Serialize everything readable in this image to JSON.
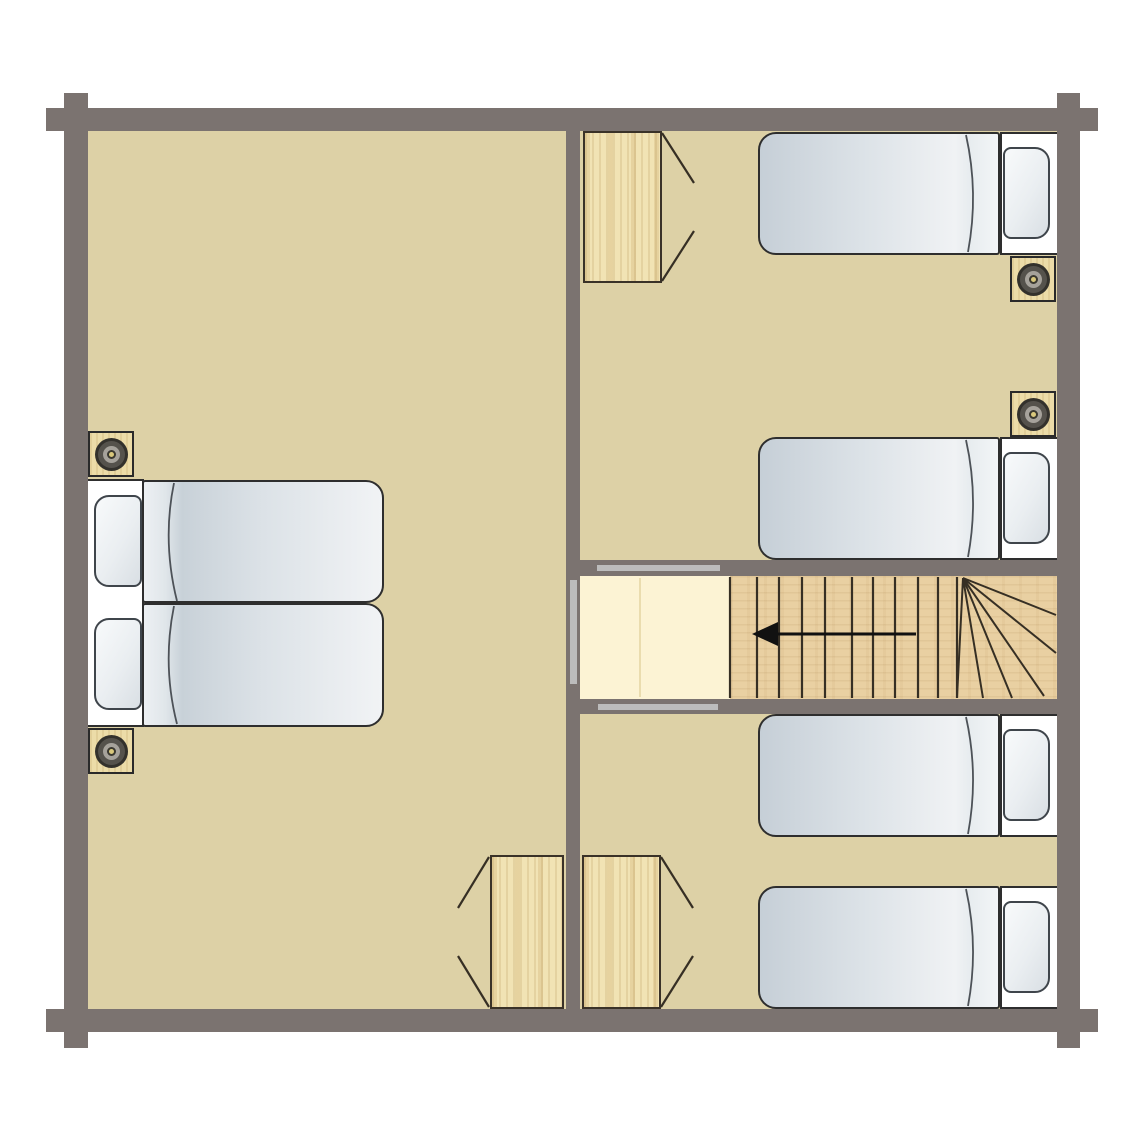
{
  "meta": {
    "type": "floor-plan",
    "subject": "log-cabin upper floor with three bedrooms and staircase",
    "canvas": {
      "width": 1145,
      "height": 1145
    }
  },
  "palette": {
    "wall": "#7b7370",
    "floor": "#ddd1a6",
    "landing": "#fcf3d4",
    "stair_wood": "#e9d0a2",
    "wardrobe_wood": "#f1e3b4",
    "fixture_wood": "#ecdca8",
    "door_marker": "#bcbcbc",
    "outline": "#2e2e2e",
    "swing_line": "#362f24",
    "arrow": "#111111",
    "mattress_dark": "#c6cfd7",
    "mattress_light": "#f3f5f7",
    "spot_center": "#d9c87c"
  },
  "floor": {
    "rect": [
      88,
      131,
      969,
      878
    ]
  },
  "rooms": [
    {
      "name": "master-bedroom",
      "bounds": [
        88,
        131,
        478,
        878
      ]
    },
    {
      "name": "twin-bedroom-north",
      "bounds": [
        580,
        131,
        477,
        429
      ]
    },
    {
      "name": "twin-bedroom-south",
      "bounds": [
        580,
        714,
        477,
        295
      ]
    },
    {
      "name": "stair-corridor",
      "bounds": [
        580,
        576,
        477,
        123
      ]
    }
  ],
  "walls": [
    {
      "name": "wall-top",
      "rect": [
        64,
        108,
        1016,
        23
      ]
    },
    {
      "name": "wall-bottom",
      "rect": [
        64,
        1009,
        1016,
        23
      ]
    },
    {
      "name": "wall-left",
      "rect": [
        64,
        108,
        24,
        924
      ]
    },
    {
      "name": "wall-right",
      "rect": [
        1057,
        108,
        23,
        924
      ]
    },
    {
      "name": "wall-interior-vertical",
      "rect": [
        566,
        131,
        14,
        878
      ]
    },
    {
      "name": "wall-corridor-top",
      "rect": [
        580,
        560,
        477,
        16
      ]
    },
    {
      "name": "wall-corridor-bottom",
      "rect": [
        580,
        699,
        477,
        15
      ]
    }
  ],
  "corner_logs": [
    {
      "name": "log-top-left-h",
      "rect": [
        46,
        108,
        18,
        23
      ]
    },
    {
      "name": "log-top-left-v",
      "rect": [
        64,
        93,
        24,
        15
      ]
    },
    {
      "name": "log-top-right-h",
      "rect": [
        1080,
        108,
        18,
        23
      ]
    },
    {
      "name": "log-top-right-v",
      "rect": [
        1057,
        93,
        23,
        15
      ]
    },
    {
      "name": "log-bottom-left-h",
      "rect": [
        46,
        1009,
        18,
        23
      ]
    },
    {
      "name": "log-bottom-left-v",
      "rect": [
        64,
        1032,
        24,
        16
      ]
    },
    {
      "name": "log-bottom-right-h",
      "rect": [
        1080,
        1009,
        18,
        23
      ]
    },
    {
      "name": "log-bottom-right-v",
      "rect": [
        1057,
        1032,
        23,
        16
      ]
    }
  ],
  "openings": [
    {
      "name": "door-opening-corridor-north",
      "rect": [
        597,
        565,
        123,
        6
      ]
    },
    {
      "name": "door-opening-corridor-south",
      "rect": [
        598,
        704,
        120,
        6
      ]
    },
    {
      "name": "door-opening-master-bedroom",
      "rect": [
        570,
        580,
        7,
        104
      ]
    }
  ],
  "double_bed": {
    "name": "double-bed",
    "frame": [
      88,
      479,
      56,
      248
    ],
    "mattresses": [
      [
        142,
        480,
        242,
        123
      ],
      [
        142,
        603,
        242,
        124
      ]
    ],
    "pillows": [
      [
        94,
        495,
        48,
        92
      ],
      [
        94,
        618,
        48,
        92
      ]
    ],
    "duvet_arcs": [
      "M174,483 Q162,541 177,601",
      "M174,606 Q162,665 177,724"
    ]
  },
  "single_beds": [
    {
      "name": "single-bed-1",
      "y": 132
    },
    {
      "name": "single-bed-2",
      "y": 437
    },
    {
      "name": "single-bed-3",
      "y": 714
    },
    {
      "name": "single-bed-4",
      "y": 886
    }
  ],
  "single_bed_geometry": {
    "mattress_x": 758,
    "mattress_w": 242,
    "mattress_h": 123,
    "frame_x": 1000,
    "frame_w": 57,
    "pillow_x": 1003,
    "pillow_w": 47,
    "pillow_h": 92,
    "pillow_dy": 15
  },
  "wardrobes": [
    {
      "name": "wardrobe-north",
      "rect": [
        583,
        131,
        79,
        152
      ],
      "swings": [
        [
          662,
          133,
          694,
          183
        ],
        [
          662,
          281,
          694,
          231
        ]
      ]
    },
    {
      "name": "wardrobe-south-left",
      "rect": [
        490,
        855,
        74,
        154
      ],
      "swings": [
        [
          489,
          857,
          458,
          908
        ],
        [
          489,
          1007,
          458,
          956
        ]
      ]
    },
    {
      "name": "wardrobe-south-right",
      "rect": [
        582,
        855,
        79,
        154
      ],
      "swings": [
        [
          661,
          857,
          693,
          908
        ],
        [
          661,
          1007,
          693,
          956
        ]
      ]
    }
  ],
  "downlights": [
    {
      "name": "downlight-master-north",
      "rect": [
        88,
        431,
        46,
        46
      ]
    },
    {
      "name": "downlight-master-south",
      "rect": [
        88,
        728,
        46,
        46
      ]
    },
    {
      "name": "downlight-twin-north",
      "rect": [
        1010,
        256,
        46,
        46
      ]
    },
    {
      "name": "downlight-twin-south",
      "rect": [
        1010,
        391,
        46,
        46
      ]
    }
  ],
  "stairs": {
    "landing": {
      "rect": [
        580,
        576,
        150,
        123
      ],
      "divider_x": 640
    },
    "treads_rect": [
      730,
      576,
      327,
      123
    ],
    "tread_lines_x": [
      730,
      757,
      779,
      802,
      825,
      852,
      873,
      895,
      918,
      938,
      957
    ],
    "tread_y": [
      577,
      698
    ],
    "winder_origin": [
      963,
      578
    ],
    "winder_ends": [
      [
        957,
        698
      ],
      [
        983,
        698
      ],
      [
        1012,
        698
      ],
      [
        1044,
        696
      ],
      [
        1056,
        653
      ],
      [
        1056,
        615
      ]
    ],
    "direction_arrow": {
      "line": [
        916,
        634,
        776,
        634
      ],
      "head": [
        [
          752,
          634
        ],
        [
          778,
          622
        ],
        [
          778,
          646
        ]
      ],
      "direction": "left-down"
    }
  }
}
